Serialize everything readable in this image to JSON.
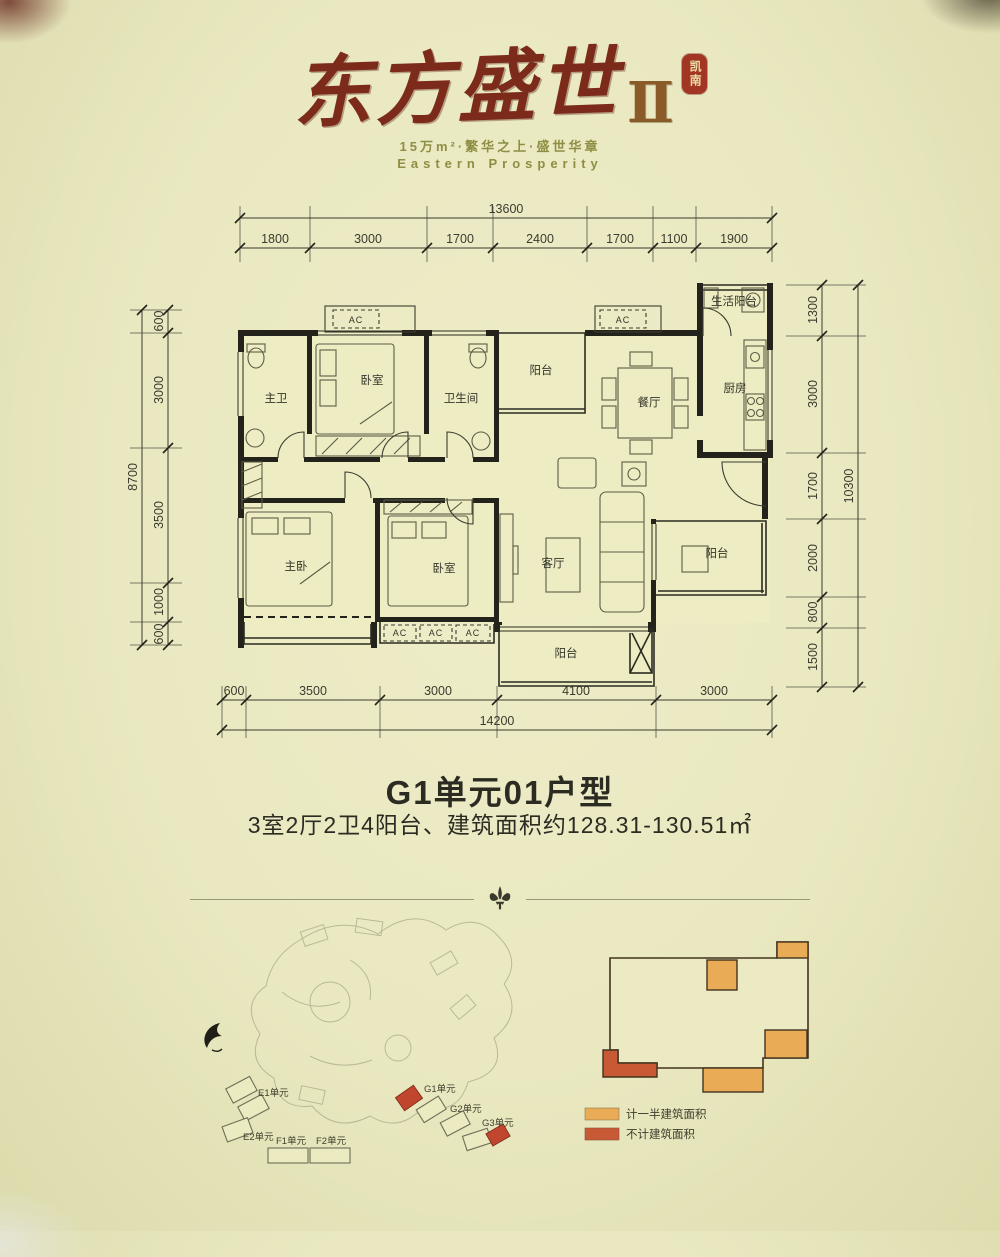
{
  "brand": {
    "logo_main": "东方盛世",
    "logo_numeral": "Ⅱ",
    "seal_text": "凯南",
    "tagline_cn": "15万m²·繁华之上·盛世华章",
    "tagline_en": "Eastern Prosperity"
  },
  "plan": {
    "ac_label": "AC",
    "room_labels": {
      "master_bath": "主卫",
      "bedroom_top": "卧室",
      "bathroom": "卫生间",
      "balcony_top": "阳台",
      "dining": "餐厅",
      "kitchen": "厨房",
      "service_balcony": "生活阳台",
      "master_bedroom": "主卧",
      "bedroom2": "卧室",
      "living": "客厅",
      "balcony_right": "阳台",
      "balcony_bottom": "阳台"
    },
    "dims": {
      "top": {
        "total": "13600",
        "segments": [
          "1800",
          "3000",
          "1700",
          "2400",
          "1700",
          "1100",
          "1900"
        ]
      },
      "left": {
        "total": "8700",
        "segments": [
          "600",
          "3000",
          "3500",
          "1000",
          "600"
        ]
      },
      "right": {
        "total": "10300",
        "segments": [
          "1300",
          "3000",
          "1700",
          "2000",
          "800",
          "1500"
        ]
      },
      "bottom": {
        "total": "14200",
        "segments": [
          "600",
          "3500",
          "3000",
          "4100",
          "3000"
        ]
      }
    }
  },
  "unit_info": {
    "title": "G1单元01户型",
    "subtitle": "3室2厅2卫4阳台、建筑面积约128.31-130.51㎡"
  },
  "site_map": {
    "units": [
      "E1单元",
      "E2单元",
      "F1单元",
      "F2单元",
      "G1单元",
      "G2单元",
      "G3单元"
    ],
    "highlight_color": "#c1462e"
  },
  "key_plan": {
    "legend": [
      {
        "label": "计一半建筑面积",
        "color": "#e9ab55"
      },
      {
        "label": "不计建筑面积",
        "color": "#c75a35"
      }
    ]
  },
  "colors": {
    "background": "#e9e8c0",
    "wall": "#23231b",
    "logo_brown": "#7c2b1b",
    "tagline_olive": "#8e8e44",
    "title_dark": "#2b2b22"
  }
}
